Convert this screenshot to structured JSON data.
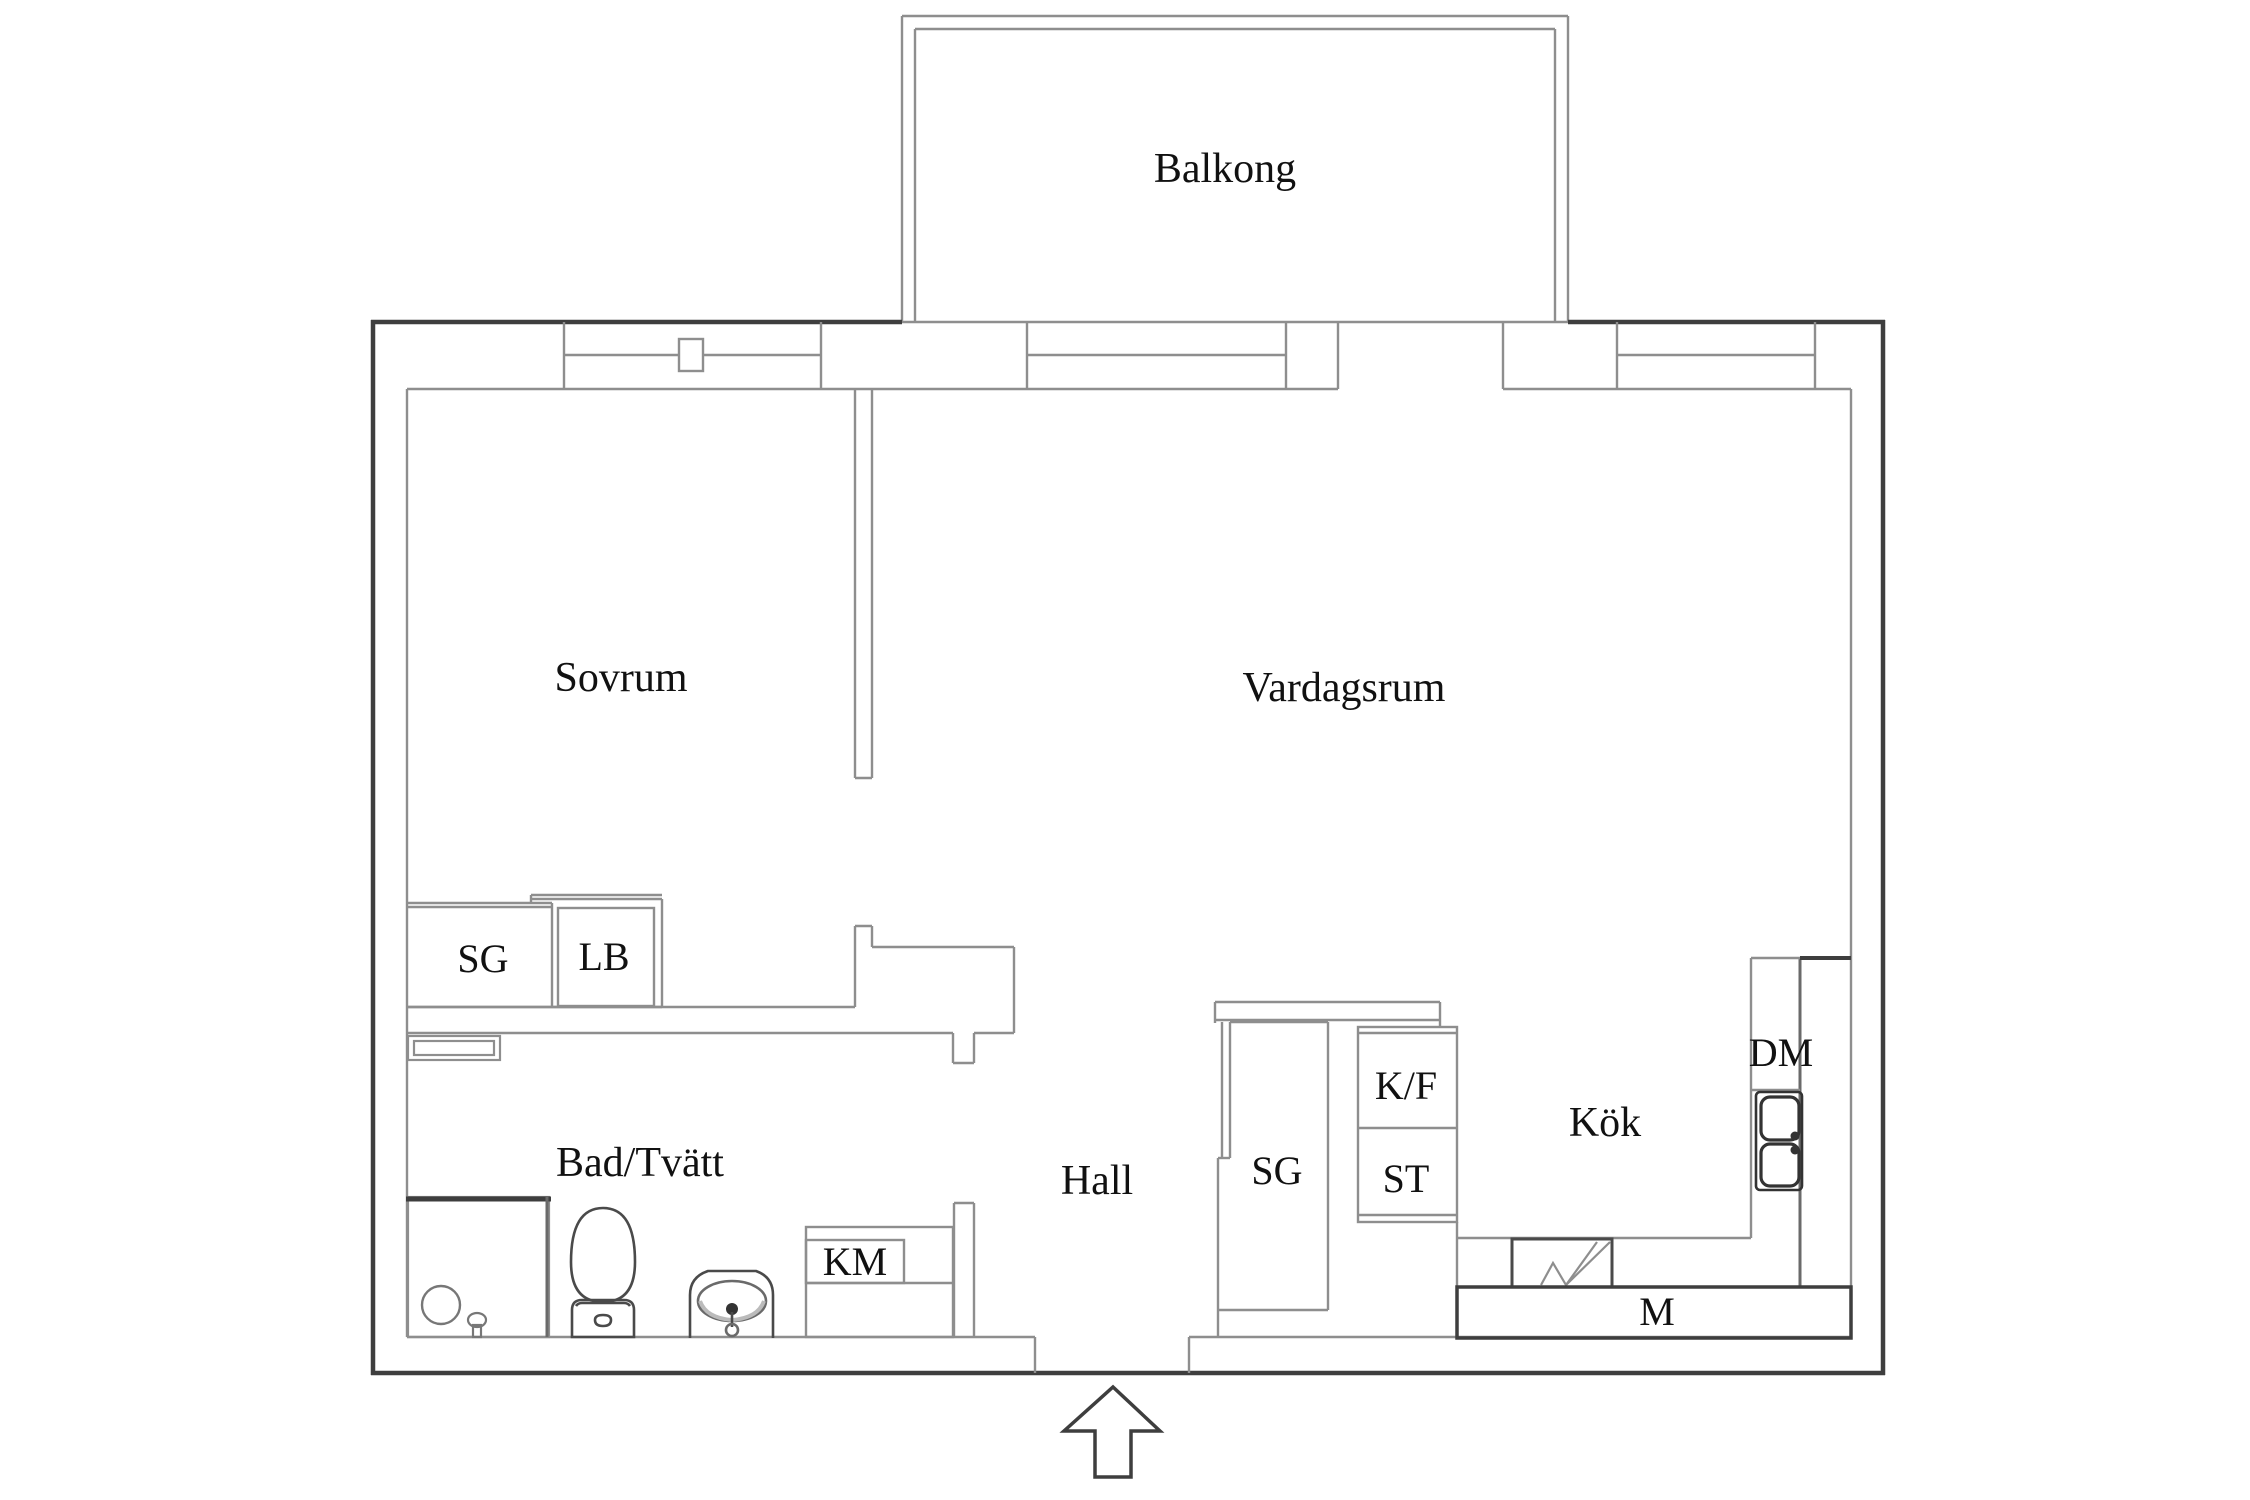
{
  "title": "Apartment floor plan",
  "rooms": {
    "balcony": "Balkong",
    "bedroom": "Sovrum",
    "living_room": "Vardagsrum",
    "bathroom": "Bad/Tvätt",
    "hall": "Hall",
    "kitchen": "Kök"
  },
  "units": {
    "bedroom_wardrobe": "SG",
    "bedroom_linen_cabinet": "LB",
    "washing_machine": "KM",
    "hall_wardrobe": "SG",
    "fridge_freezer": "K/F",
    "tall_cabinet": "ST",
    "dishwasher": "DM",
    "microwave_bench": "M"
  },
  "icons": {
    "entrance_arrow": "block arrow pointing up at entry door",
    "toilet": "toilet symbol",
    "bathroom_sink": "washbasin symbol",
    "shower_drain": "shower with drain circle",
    "kitchen_sink": "double-bowl sink symbol",
    "stove": "stove zigzag symbol",
    "window_handle": "window handle square"
  },
  "colors": {
    "background": "#ffffff",
    "wall_dark": "#3e3e3e",
    "wall_gray": "#8e8e8e",
    "fixture_gray": "#5a5a5a",
    "text": "#111111"
  }
}
